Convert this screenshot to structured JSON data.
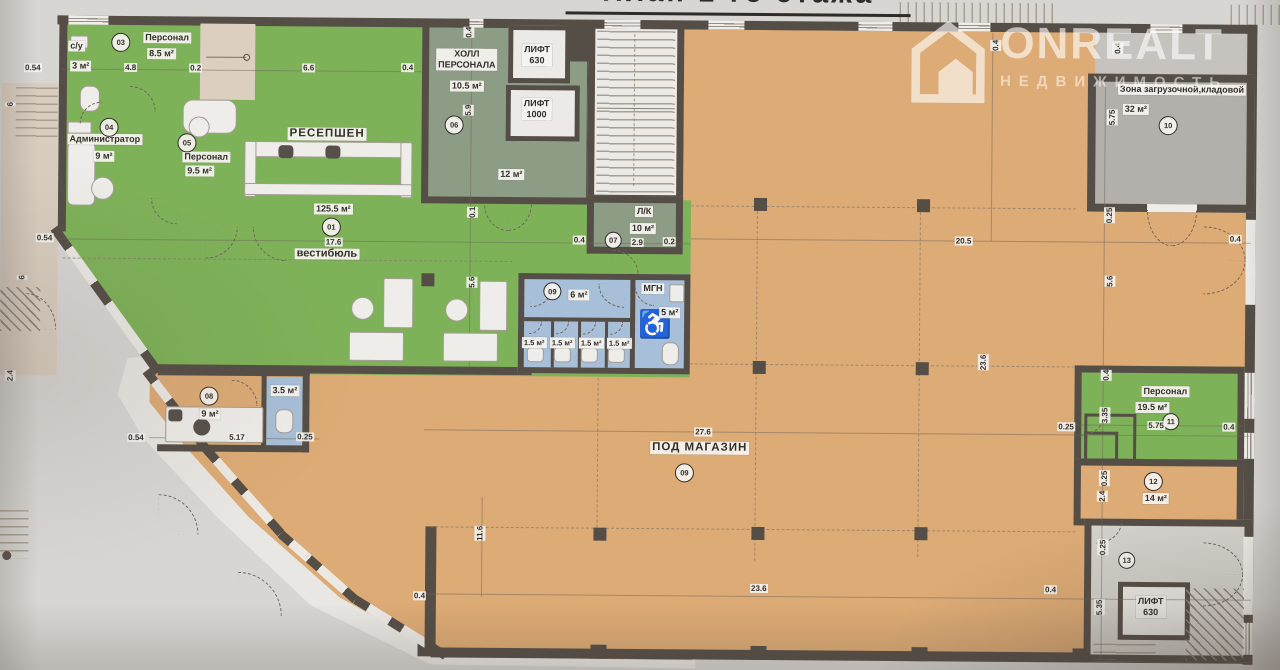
{
  "title": "План 1-го этажа",
  "watermark": {
    "brand": "ONREALT",
    "subtitle": "НЕДВИЖИМОСТЬ"
  },
  "icons": {
    "wheelchair": "♿",
    "house_logo": "house-icon"
  },
  "colors": {
    "wall": "#554e47",
    "green_room": "#7eb258",
    "blue_wet_room": "#a7bfd8",
    "retail_orange": "#ddab75",
    "sage_hall": "#8d9c85",
    "loading_gray": "#b3afaa",
    "paper": "#d8d6d3"
  },
  "rooms": {
    "vestibule": {
      "num": "01",
      "name": "вестибюль",
      "area": "125.5 м²"
    },
    "su": {
      "name": "с/у",
      "area": "3 м²"
    },
    "staff_83": {
      "num": "03",
      "name": "Персонал",
      "area": "8.5 м²"
    },
    "admin": {
      "num": "04",
      "name": "Администратор",
      "area": "9 м²"
    },
    "staff_95": {
      "num": "05",
      "name": "Персонал",
      "area": "9.5 м²"
    },
    "staff_hall": {
      "num": "06",
      "line1": "ХОЛЛ",
      "line2": "ПЕРСОНАЛА",
      "area": "10.5 м²",
      "area2": "12 м²"
    },
    "lk": {
      "num": "07",
      "name": "Л/К",
      "area": "10 м²"
    },
    "room08": {
      "num": "08",
      "area": "9 м²"
    },
    "wc_block": {
      "num": "09",
      "area": "6 м²",
      "stall": "1.5 м²",
      "mgn": "МГН",
      "mgn_area": "5 м²"
    },
    "wc_35": {
      "area": "3.5 м²"
    },
    "shop": {
      "num": "09",
      "name": "ПОД МАГАЗИН"
    },
    "loading": {
      "num": "10",
      "name": "Зона загрузочной,кладовой",
      "area": "32 м²"
    },
    "staff_195": {
      "num": "11",
      "name": "Персонал",
      "area": "19.5 м²"
    },
    "room12": {
      "num": "12",
      "area": "14 м²"
    },
    "room13": {
      "num": "13"
    },
    "reception": {
      "name": "РЕСЕПШЕН"
    },
    "lift_top": {
      "name": "ЛИФТ",
      "cap": "630"
    },
    "lift_1000": {
      "name": "ЛИФТ",
      "cap": "1000"
    },
    "lift_bottom": {
      "name": "ЛИФТ",
      "cap": "630"
    }
  },
  "dims": [
    "0.54",
    "6",
    "0.54",
    "6",
    "2.4",
    "4.8",
    "0.2",
    "6.6",
    "0.4",
    "0.4",
    "5.9",
    "0.1",
    "0.4",
    "2.9",
    "0.2",
    "0.4",
    "0.4",
    "5.75",
    "0.25",
    "20.5",
    "0.4",
    "23.6",
    "5.6",
    "5.6",
    "17.6",
    "5.17",
    "0.25",
    "0.54",
    "27.6",
    "11.6",
    "23.6",
    "0.4",
    "0.4",
    "0.4",
    "3.35",
    "5.75",
    "0.4",
    "0.25",
    "0.25",
    "2.4",
    "0.25",
    "5.35"
  ]
}
